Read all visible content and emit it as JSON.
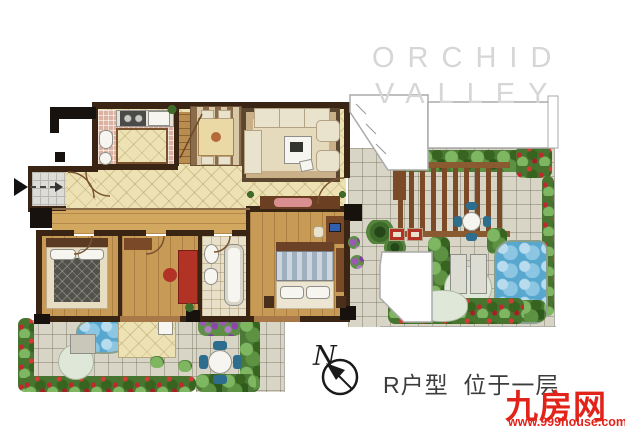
{
  "watermark": {
    "line1": "ORCHID",
    "line2": "VALLEY"
  },
  "compass": {
    "label": "N"
  },
  "caption": {
    "text": "R户型  位于一层"
  },
  "brand": {
    "logo": "九房网",
    "site": "www.999house.com"
  },
  "colors": {
    "logo_red": "#e2231a",
    "watermark_gray": "#d6d6d6",
    "caption_dark": "#3c3c3c",
    "wall_brown": "#3a2414",
    "floor_cream": "#ece2b4",
    "wood_floor": "#c79a55",
    "kitchen_pink": "#dcb3a3",
    "garden_green": "#4c7a36",
    "flower_red": "#c1272d",
    "flower_purple": "#9b59b6",
    "water_blue": "#58a7cf",
    "paving_gray": "#d8d5c7",
    "pergola_brown": "#7b4a26"
  }
}
